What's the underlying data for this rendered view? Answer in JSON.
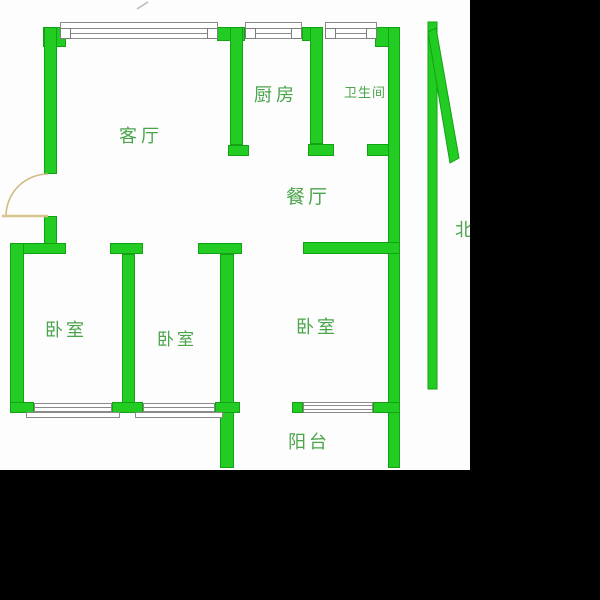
{
  "title": "apartment-floor-plan",
  "colors": {
    "background": "#000000",
    "plan_background": "#fdfdfd",
    "wall_green": "#22cc22",
    "wall_edge_green": "#12a312",
    "label_green": "#4aa44a",
    "door_tan": "#cfbc82",
    "window_gray": "#8a8a8a"
  },
  "rooms": {
    "living": {
      "label": "客厅"
    },
    "kitchen": {
      "label": "厨房"
    },
    "bathroom": {
      "label": "卫生间"
    },
    "dining": {
      "label": "餐厅"
    },
    "bedroom1": {
      "label": "卧室"
    },
    "bedroom2": {
      "label": "卧室"
    },
    "bedroom3": {
      "label": "卧室"
    },
    "balcony": {
      "label": "阳台"
    }
  },
  "compass": {
    "north_label": "北"
  }
}
